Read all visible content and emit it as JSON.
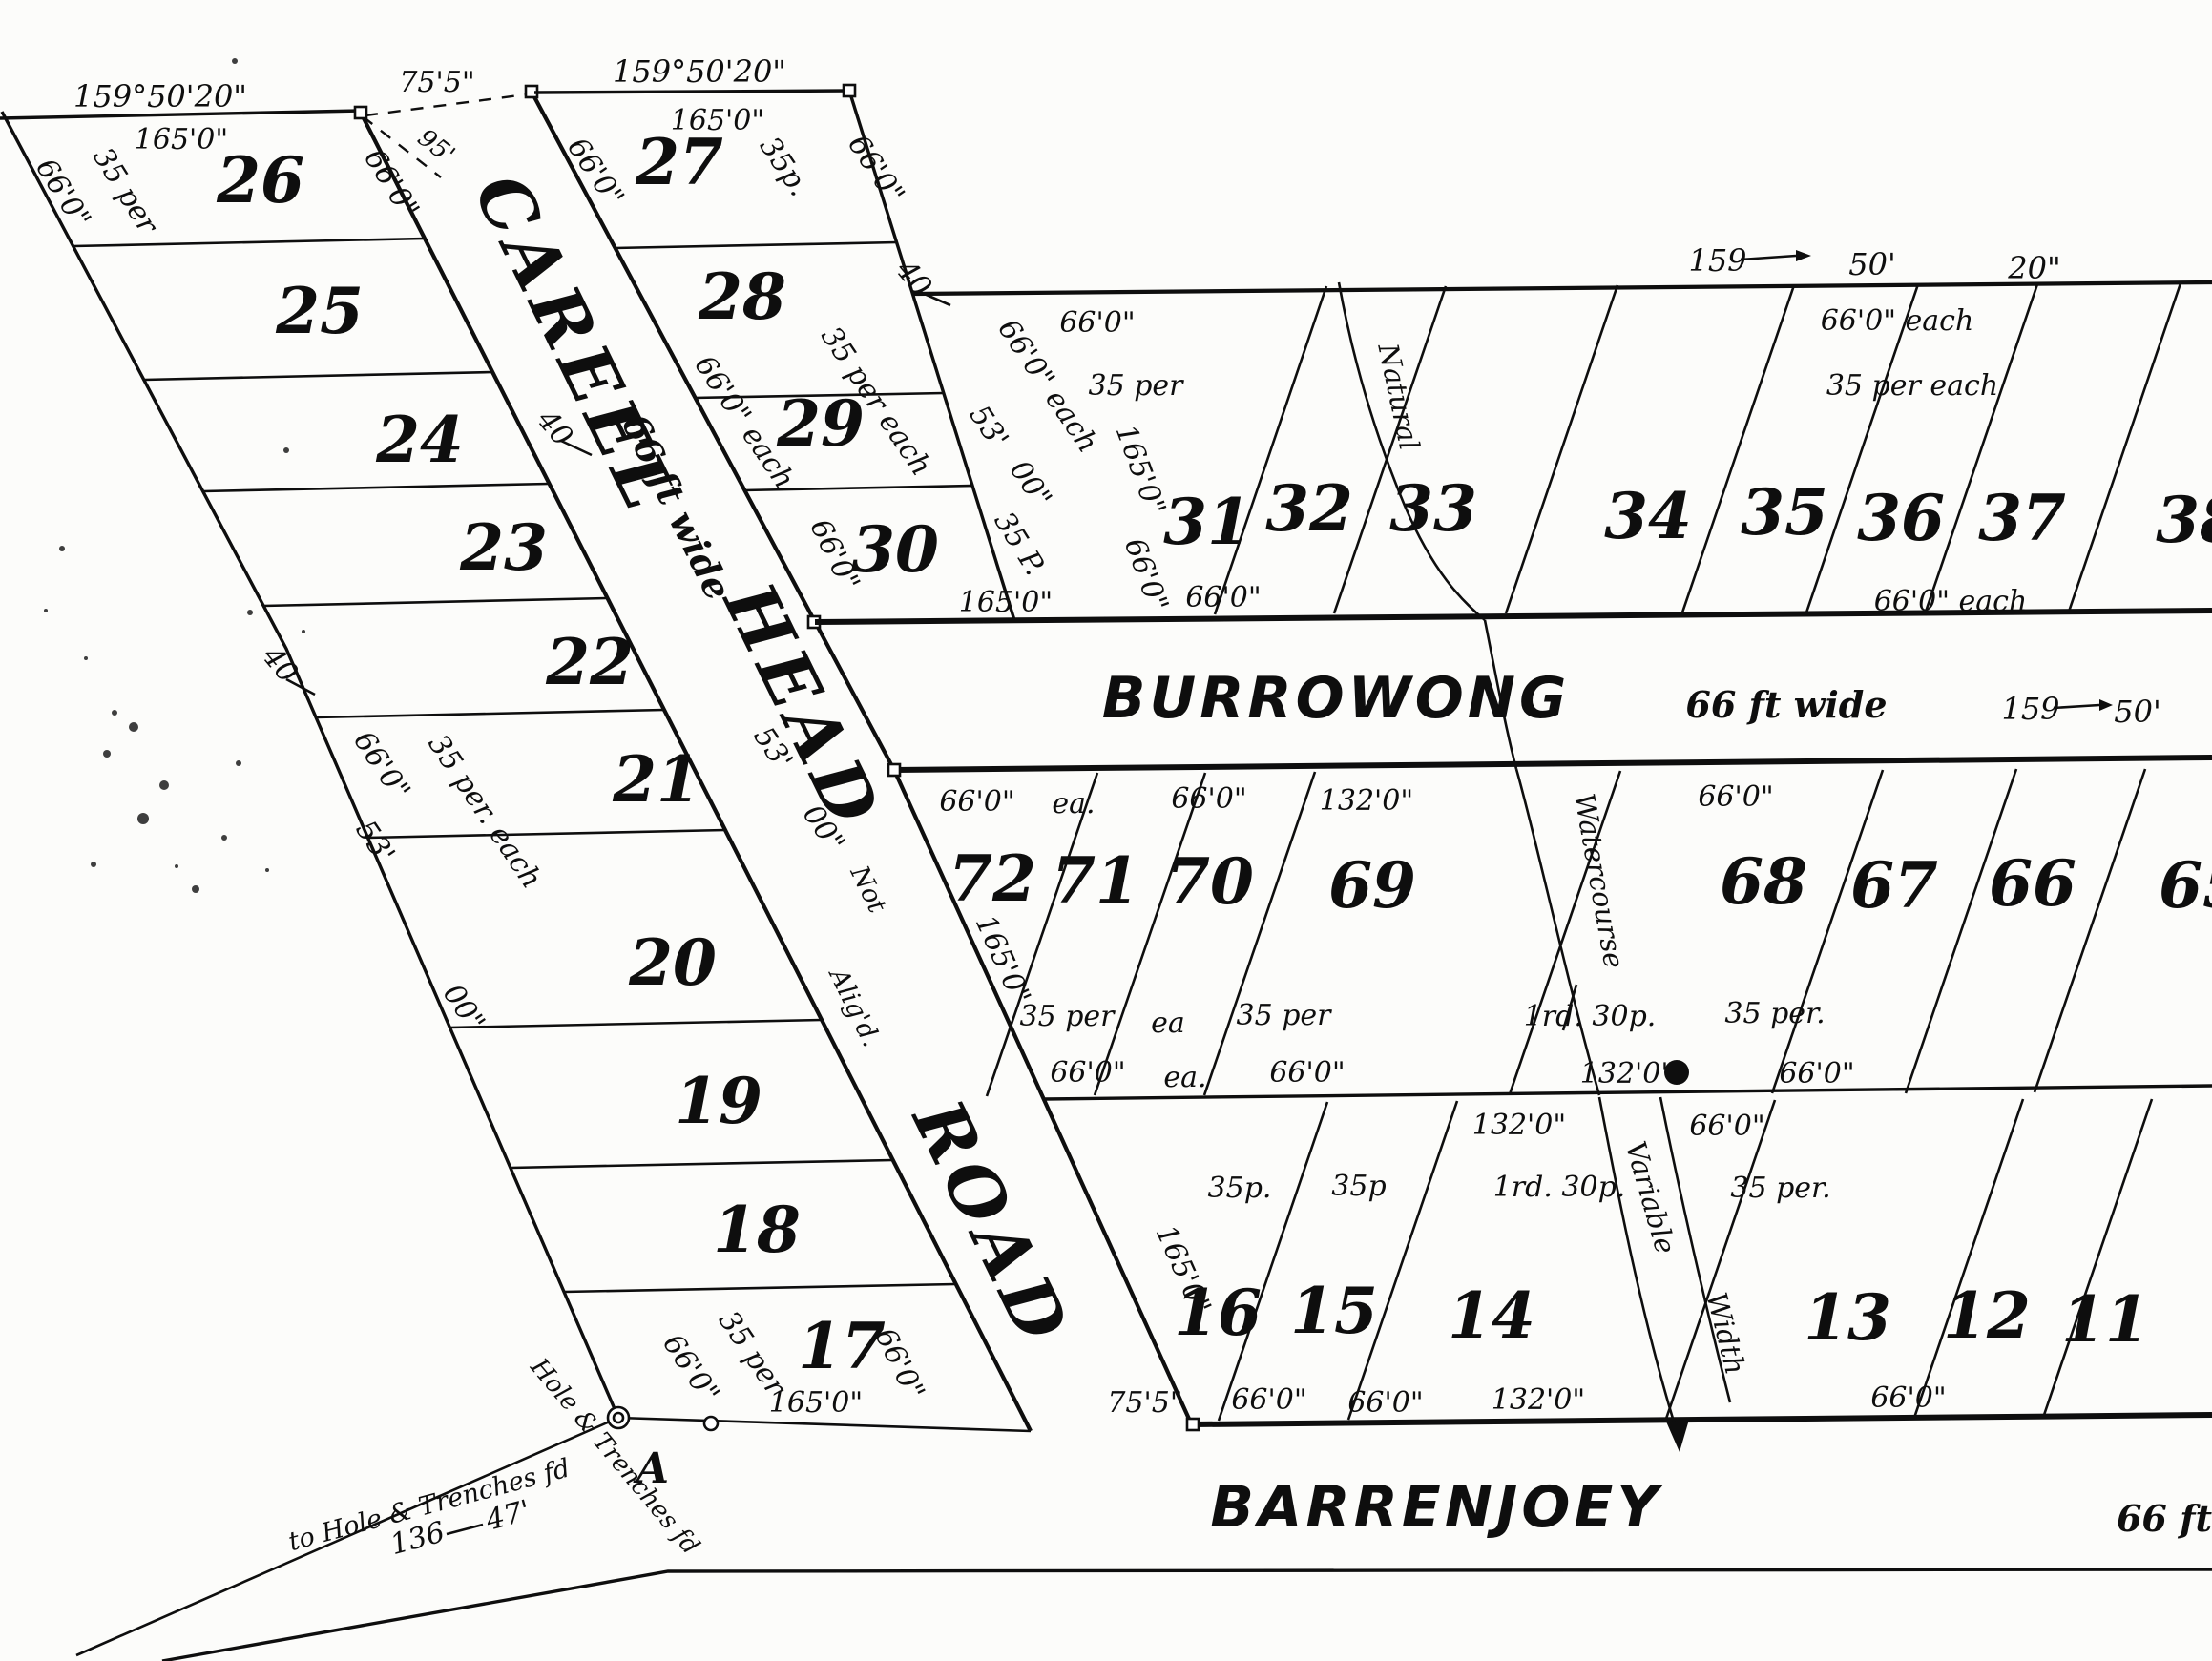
{
  "roads": {
    "careel_head": {
      "name_word1": "CAREEL",
      "name_word2": "HEAD",
      "name_word3": "ROAD",
      "width_label": "66 ft wide",
      "alignment_note_word1": "Not",
      "alignment_note_word2": "Alig'd."
    },
    "burrowong": {
      "name": "BURROWONG",
      "width_label": "66 ft wide",
      "bearing_deg": "159",
      "bearing_min": "50'"
    },
    "barrenjoey": {
      "name": "BARRENJOEY",
      "width_label": "66 ft"
    }
  },
  "lots_west": [
    "26",
    "25",
    "24",
    "23",
    "22",
    "21",
    "20",
    "19",
    "18",
    "17"
  ],
  "lots_road_col": [
    "27",
    "28",
    "29",
    "30"
  ],
  "lots_north_row": [
    "31",
    "32",
    "33",
    "34",
    "35",
    "36",
    "37",
    "38"
  ],
  "lots_mid_row": [
    "72",
    "71",
    "70",
    "69",
    "68",
    "67",
    "66",
    "65"
  ],
  "lots_south_row": [
    "16",
    "15",
    "14",
    "13",
    "12",
    "11"
  ],
  "bearings": {
    "top_west": "159°50'20\"",
    "top_mid": "159°50'20\"",
    "north_deg": "159",
    "north_min": "50'",
    "north_sec": "20\"",
    "burrowong_deg": "159",
    "burrowong_min": "50'"
  },
  "dims": {
    "d165": "165'0\"",
    "d66": "66'0\"",
    "d66_each": "66'0\" each",
    "d132": "132'0\"",
    "d75_5": "75'5\"",
    "d95": "95'",
    "d40": "40",
    "d53": "53'",
    "d00": "00\"",
    "d136": "136",
    "d47": "47'"
  },
  "areas": {
    "a35_per": "35 per",
    "a35_per_dot": "35 per.",
    "a35_per_each": "35 per each",
    "a35_per_dot_each": "35 per. each",
    "a35p": "35p.",
    "a35p2": "35p",
    "a35_P": "35 P.",
    "ea_dot": "ea.",
    "ea": "ea",
    "rood": "1rd. 30p."
  },
  "features": {
    "natural": "Natural",
    "watercourse": "Watercourse",
    "variable": "Variable",
    "width": "Width"
  },
  "annotations": {
    "tie_line": "to Hole & Trenches fd",
    "tie_deg": "136",
    "tie_dist": "47'",
    "corner_note": "Hole & Trenches fd",
    "corner_letter": "A"
  }
}
